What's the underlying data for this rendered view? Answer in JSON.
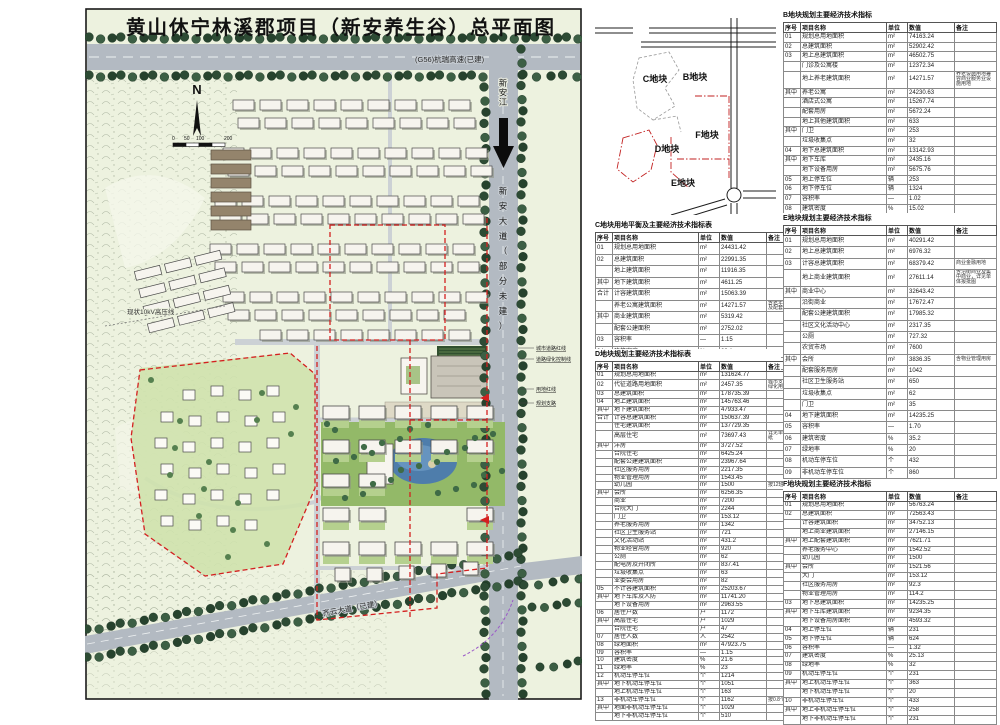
{
  "plan": {
    "title": "黄山休宁林溪郡项目（新安养生谷）总平面图",
    "labels": {
      "highway": "(G56)杭瑞高速(已建)",
      "avenue": "新安大道（部分未建）",
      "river": "新安江",
      "south_road": "齐云大道（已建）",
      "powerline": "现状10kV高压线",
      "north": "N",
      "scale_ticks": [
        "0",
        "50",
        "100",
        "200"
      ]
    },
    "annotations": [
      "城市道路红线",
      "道路绿化控制线",
      "用地红线",
      "规划支路"
    ]
  },
  "keymap": {
    "plots": [
      "C地块",
      "B地块",
      "F地块",
      "D地块",
      "E地块"
    ]
  },
  "tables": [
    {
      "id": "B",
      "title": "B地块规划主要经济技术指标",
      "headers": [
        "序号",
        "项目名称",
        "单位",
        "数值",
        "备注"
      ],
      "rows": [
        [
          "01",
          "规划总用地面积",
          "m²",
          "74163.24",
          ""
        ],
        [
          "02",
          "总建筑面积",
          "m²",
          "52902.42",
          ""
        ],
        [
          "03",
          "地上总建筑面积",
          "m²",
          "46502.75",
          ""
        ],
        [
          "",
          "门诊及公寓楼",
          "m²",
          "12372.34",
          ""
        ],
        [
          "",
          "地上养老建筑面积",
          "m²",
          "14271.57",
          "养老设施用地兼容商业服务业设施用地"
        ],
        [
          "其中",
          "养老公寓",
          "m²",
          "24230.63",
          ""
        ],
        [
          "",
          "酒店式公寓",
          "m²",
          "15267.74",
          ""
        ],
        [
          "",
          "配套用房",
          "m²",
          "5672.24",
          ""
        ],
        [
          "",
          "地上其他建筑面积",
          "m²",
          "633",
          ""
        ],
        [
          "其中",
          "门卫",
          "m²",
          "253",
          ""
        ],
        [
          "",
          "垃圾收集点",
          "m²",
          "32",
          ""
        ],
        [
          "04",
          "地下总建筑面积",
          "m²",
          "13142.93",
          ""
        ],
        [
          "其中",
          "地下车库",
          "m²",
          "2435.16",
          ""
        ],
        [
          "",
          "地下设备用房",
          "m²",
          "5675.76",
          ""
        ],
        [
          "05",
          "地上停车位",
          "辆",
          "253",
          ""
        ],
        [
          "06",
          "地下停车位",
          "辆",
          "1324",
          ""
        ],
        [
          "07",
          "容积率",
          "—",
          "1.02",
          ""
        ],
        [
          "08",
          "建筑密度",
          "%",
          "15.02",
          ""
        ],
        [
          "09",
          "绿地率",
          "%",
          "32",
          ""
        ],
        [
          "10",
          "机动车停车位",
          "个",
          "243",
          ""
        ],
        [
          "11",
          "非机动车停车位",
          "个",
          "450",
          ""
        ]
      ]
    },
    {
      "id": "C",
      "title": "C地块用地平衡及主要经济技术指标表",
      "headers": [
        "序号",
        "项目名称",
        "单位",
        "数值",
        "备注"
      ],
      "rows": [
        [
          "01",
          "规划总用地面积",
          "m²",
          "24431.42",
          ""
        ],
        [
          "02",
          "总建筑面积",
          "m²",
          "22991.35",
          ""
        ],
        [
          "",
          "地上建筑面积",
          "m²",
          "11916.35",
          ""
        ],
        [
          "其中",
          "地下建筑面积",
          "m²",
          "4611.25",
          ""
        ],
        [
          "合计",
          "计容建筑面积",
          "m²",
          "15063.39",
          ""
        ],
        [
          "",
          "养老公寓建筑面积",
          "m²",
          "14271.57",
          "含老年活动中心及配套服务用房"
        ],
        [
          "其中",
          "商业建筑面积",
          "m²",
          "5319.42",
          ""
        ],
        [
          "",
          "配套公建面积",
          "m²",
          "2752.02",
          ""
        ],
        [
          "03",
          "容积率",
          "—",
          "1.15",
          ""
        ],
        [
          "04",
          "建筑密度",
          "%",
          "23.1",
          ""
        ],
        [
          "05",
          "绿地率",
          "%",
          "30",
          ""
        ]
      ]
    },
    {
      "id": "D",
      "title": "D地块规划主要经济技术指标表",
      "headers": [
        "序号",
        "项目名称",
        "单位",
        "数值",
        "备注"
      ],
      "rows": [
        [
          "01",
          "规划总用地面积",
          "m²",
          "131624.77",
          ""
        ],
        [
          "02",
          "代征道路用地面积",
          "m²",
          "2457.35",
          "城市支路及市政绿化用地"
        ],
        [
          "03",
          "总建筑面积",
          "m²",
          "178735.39",
          ""
        ],
        [
          "04",
          "地上建筑面积",
          "m²",
          "145763.46",
          ""
        ],
        [
          "其中",
          "地下建筑面积",
          "m²",
          "47933.47",
          ""
        ],
        [
          "合计",
          "计容总建筑面积",
          "m²",
          "150637.39",
          ""
        ],
        [
          "",
          "住宅建筑面积",
          "m²",
          "137729.35",
          ""
        ],
        [
          "",
          "高层住宅",
          "m²",
          "73697.43",
          "详见单体报批图纸"
        ],
        [
          "其中",
          "洋房",
          "m²",
          "3727.52",
          ""
        ],
        [
          "",
          "合院住宅",
          "m²",
          "6425.24",
          ""
        ],
        [
          "",
          "配套公建建筑面积",
          "m²",
          "23967.64",
          ""
        ],
        [
          "",
          "社区服务用房",
          "m²",
          "2217.35",
          ""
        ],
        [
          "",
          "物业管理用房",
          "m²",
          "1543.45",
          ""
        ],
        [
          "",
          "幼儿园",
          "m²",
          "1500",
          "按12班规模预留"
        ],
        [
          "其中",
          "会所",
          "m²",
          "6256.35",
          ""
        ],
        [
          "",
          "商业",
          "m²",
          "7200",
          ""
        ],
        [
          "",
          "合院大门",
          "m²",
          "2244",
          ""
        ],
        [
          "",
          "门卫",
          "m²",
          "153.12",
          ""
        ],
        [
          "",
          "养老服务用房",
          "m²",
          "1342",
          ""
        ],
        [
          "",
          "社区卫生服务站",
          "m²",
          "721",
          ""
        ],
        [
          "",
          "文化活动站",
          "m²",
          "431.2",
          ""
        ],
        [
          "",
          "物业经营用房",
          "m²",
          "920",
          ""
        ],
        [
          "",
          "公厕",
          "m²",
          "62",
          ""
        ],
        [
          "",
          "配电房及开闭所",
          "m²",
          "837.41",
          ""
        ],
        [
          "",
          "垃圾收集点",
          "m²",
          "63",
          ""
        ],
        [
          "",
          "业委会用房",
          "m²",
          "82",
          ""
        ],
        [
          "05",
          "不计容建筑面积",
          "m²",
          "25203.67",
          ""
        ],
        [
          "其中",
          "地下车库及人防",
          "m²",
          "11741.20",
          ""
        ],
        [
          "",
          "地下设备用房",
          "m²",
          "2963.55",
          ""
        ],
        [
          "06",
          "居住户数",
          "户",
          "1172",
          ""
        ],
        [
          "其中",
          "高层住宅",
          "户",
          "1029",
          ""
        ],
        [
          "",
          "合院住宅",
          "户",
          "47",
          ""
        ],
        [
          "07",
          "居住人数",
          "人",
          "2542",
          ""
        ],
        [
          "08",
          "绿地面积",
          "m²",
          "47923.75",
          ""
        ],
        [
          "09",
          "容积率",
          "—",
          "1.15",
          ""
        ],
        [
          "10",
          "建筑密度",
          "%",
          "21.6",
          ""
        ],
        [
          "11",
          "绿地率",
          "%",
          "23",
          ""
        ],
        [
          "12",
          "机动车停车位",
          "个",
          "1214",
          ""
        ],
        [
          "其中",
          "地下机动车停车位",
          "个",
          "1051",
          ""
        ],
        [
          "",
          "地上机动车停车位",
          "个",
          "163",
          ""
        ],
        [
          "13",
          "非机动车停车位",
          "个",
          "1162",
          "按0.8个/户配建"
        ],
        [
          "其中",
          "地面非机动车停车位",
          "个",
          "1029",
          ""
        ],
        [
          "",
          "地下非机动车停车位",
          "个",
          "510",
          ""
        ]
      ]
    },
    {
      "id": "E",
      "title": "E地块规划主要经济技术指标",
      "headers": [
        "序号",
        "项目名称",
        "单位",
        "数值",
        "备注"
      ],
      "rows": [
        [
          "01",
          "规划总用地面积",
          "m²",
          "40291.42",
          ""
        ],
        [
          "02",
          "地上总建筑面积",
          "m²",
          "6976.32",
          ""
        ],
        [
          "03",
          "计容总建筑面积",
          "m²",
          "68379.42",
          "商业金融用地"
        ],
        [
          "",
          "地上商业建筑面积",
          "m²",
          "27611.14",
          "含沿街商业及集中商业，详见单体报批图"
        ],
        [
          "其中",
          "商业中心",
          "m²",
          "32643.42",
          ""
        ],
        [
          "",
          "沿街商业",
          "m²",
          "17672.47",
          ""
        ],
        [
          "",
          "配套公建建筑面积",
          "m²",
          "17985.32",
          ""
        ],
        [
          "",
          "社区文化活动中心",
          "m²",
          "2317.35",
          ""
        ],
        [
          "",
          "公厕",
          "m²",
          "727.32",
          ""
        ],
        [
          "",
          "农贸市场",
          "m²",
          "7600",
          ""
        ],
        [
          "其中",
          "会所",
          "m²",
          "3836.35",
          "含物业管理用房"
        ],
        [
          "",
          "配套服务用房",
          "m²",
          "1042",
          ""
        ],
        [
          "",
          "社区卫生服务站",
          "m²",
          "650",
          ""
        ],
        [
          "",
          "垃圾收集点",
          "m²",
          "62",
          ""
        ],
        [
          "",
          "门卫",
          "m²",
          "35",
          ""
        ],
        [
          "04",
          "地下建筑面积",
          "m²",
          "14235.25",
          ""
        ],
        [
          "05",
          "容积率",
          "—",
          "1.70",
          ""
        ],
        [
          "06",
          "建筑密度",
          "%",
          "35.2",
          ""
        ],
        [
          "07",
          "绿地率",
          "%",
          "20",
          ""
        ],
        [
          "08",
          "机动车停车位",
          "个",
          "432",
          ""
        ],
        [
          "09",
          "非机动车停车位",
          "个",
          "860",
          ""
        ]
      ]
    },
    {
      "id": "F",
      "title": "F地块规划主要经济技术指标",
      "headers": [
        "序号",
        "项目名称",
        "单位",
        "数值",
        "备注"
      ],
      "rows": [
        [
          "01",
          "规划总用地面积",
          "m²",
          "56763.24",
          ""
        ],
        [
          "02",
          "总建筑面积",
          "m²",
          "72563.43",
          ""
        ],
        [
          "",
          "计容建筑面积",
          "m²",
          "34752.13",
          ""
        ],
        [
          "",
          "地上商业建筑面积",
          "m²",
          "27146.15",
          ""
        ],
        [
          "其中",
          "地上配套建筑面积",
          "m²",
          "7621.71",
          ""
        ],
        [
          "",
          "养老服务中心",
          "m²",
          "1542.52",
          ""
        ],
        [
          "",
          "幼儿园",
          "m²",
          "1500",
          ""
        ],
        [
          "其中",
          "会所",
          "m²",
          "1521.56",
          ""
        ],
        [
          "",
          "大门",
          "m²",
          "153.12",
          ""
        ],
        [
          "",
          "社区服务用房",
          "m²",
          "92.3",
          ""
        ],
        [
          "",
          "物业管理用房",
          "m²",
          "114.2",
          ""
        ],
        [
          "03",
          "地下总建筑面积",
          "m²",
          "14235.25",
          ""
        ],
        [
          "其中",
          "地下车库建筑面积",
          "m²",
          "9234.35",
          ""
        ],
        [
          "",
          "地下设备用房面积",
          "m²",
          "4593.32",
          ""
        ],
        [
          "04",
          "地上停车位",
          "辆",
          "231",
          ""
        ],
        [
          "05",
          "地下停车位",
          "辆",
          "624",
          ""
        ],
        [
          "06",
          "容积率",
          "—",
          "1.32",
          ""
        ],
        [
          "07",
          "建筑密度",
          "%",
          "25.13",
          ""
        ],
        [
          "08",
          "绿地率",
          "%",
          "32",
          ""
        ],
        [
          "09",
          "机动车停车位",
          "个",
          "231",
          ""
        ],
        [
          "其中",
          "地上机动车停车位",
          "个",
          "363",
          ""
        ],
        [
          "",
          "地下机动车停车位",
          "个",
          "20",
          ""
        ],
        [
          "10",
          "非机动车停车位",
          "个",
          "433",
          ""
        ],
        [
          "其中",
          "地上非机动车停车位",
          "个",
          "258",
          ""
        ],
        [
          "",
          "地下非机动车停车位",
          "个",
          "231",
          ""
        ]
      ]
    }
  ]
}
